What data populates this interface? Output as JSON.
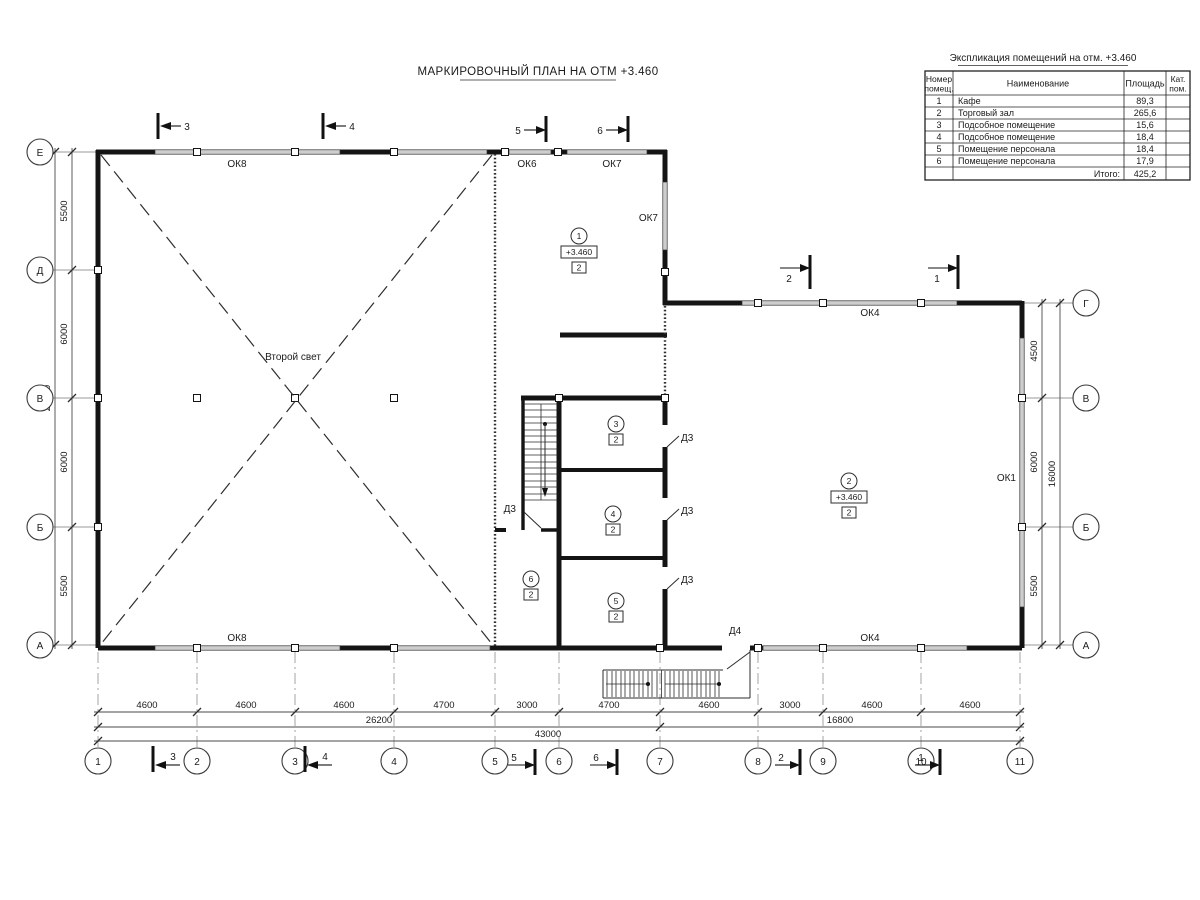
{
  "drawing": {
    "title": "МАРКИРОВОЧНЫЙ ПЛАН НА ОТМ +3.460",
    "second_light": "Второй свет"
  },
  "explication": {
    "title": "Экспликация помещений на отм. +3.460",
    "headers": {
      "number1": "Номер",
      "number2": "помещ.",
      "name": "Наименование",
      "area": "Площадь",
      "cat1": "Кат.",
      "cat2": "пом."
    },
    "rows": [
      {
        "num": "1",
        "name": "Кафе",
        "area": "89,3"
      },
      {
        "num": "2",
        "name": "Торговый зал",
        "area": "265,6"
      },
      {
        "num": "3",
        "name": "Подсобное помещение",
        "area": "15,6"
      },
      {
        "num": "4",
        "name": "Подсобное помещение",
        "area": "18,4"
      },
      {
        "num": "5",
        "name": "Помещение персонала",
        "area": "18,4"
      },
      {
        "num": "6",
        "name": "Помещение персонала",
        "area": "17,9"
      }
    ],
    "total_label": "Итого:",
    "total_value": "425,2"
  },
  "axes": {
    "left": [
      "Е",
      "Д",
      "В",
      "Б",
      "А"
    ],
    "right": [
      "Г",
      "В",
      "Б",
      "А"
    ],
    "bottom": [
      "1",
      "2",
      "3",
      "4",
      "5",
      "6",
      "7",
      "8",
      "9",
      "10",
      "11"
    ]
  },
  "dims": {
    "left": [
      "5500",
      "6000",
      "6000",
      "5500"
    ],
    "left_total": "23000",
    "right": [
      "4500",
      "6000",
      "5500"
    ],
    "right_total": "16000",
    "bottom": [
      "4600",
      "4600",
      "4600",
      "4700",
      "3000",
      "4700",
      "4600",
      "3000",
      "4600",
      "4600"
    ],
    "bottom_sub": [
      "26200",
      "16800"
    ],
    "bottom_total": "43000"
  },
  "sections": {
    "top": [
      "3",
      "4",
      "5",
      "6"
    ],
    "right": [
      "2",
      "1"
    ],
    "bottom": [
      "3",
      "4",
      "5",
      "6",
      "2",
      "1"
    ]
  },
  "windows": {
    "ok8_top": "ОК8",
    "ok6": "ОК6",
    "ok7_top": "ОК7",
    "ok7_side": "ОК7",
    "ok4_top": "ОК4",
    "ok1": "ОК1",
    "ok8_bottom": "ОК8",
    "ok4_bottom": "ОК4"
  },
  "doors": {
    "d3": "Д3",
    "d4": "Д4"
  },
  "rooms": {
    "r1": {
      "num": "1",
      "elev": "+3.460",
      "cat": "2"
    },
    "r2": {
      "num": "2",
      "elev": "+3.460",
      "cat": "2"
    },
    "r3": {
      "num": "3",
      "cat": "2"
    },
    "r4": {
      "num": "4",
      "cat": "2"
    },
    "r5": {
      "num": "5",
      "cat": "2"
    },
    "r6": {
      "num": "6",
      "cat": "2"
    }
  }
}
